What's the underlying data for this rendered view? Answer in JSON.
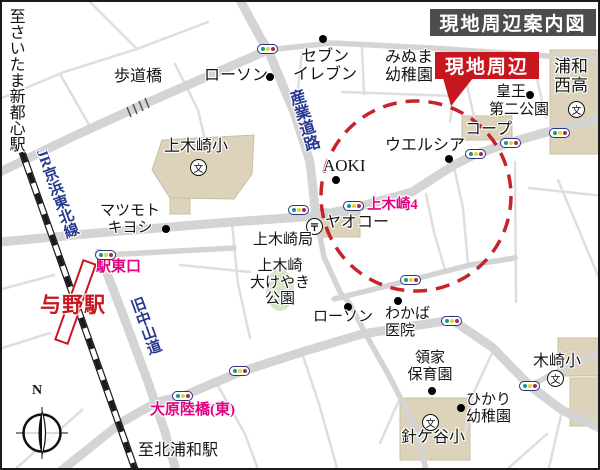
{
  "map": {
    "title": "現地周辺案内図",
    "site_badge": "現地周辺",
    "compass_north": "N"
  },
  "symbols": {
    "school": "文",
    "post_office": "〒"
  },
  "colors": {
    "site_red": "#c7161e",
    "badge_gray": "#4f4c4d",
    "pink": "#e4007f",
    "road_blue": "#273a8f",
    "circle_red": "#c7232b",
    "road_gray": "#d4d4d4",
    "road_light": "#dedede",
    "tan": "#ddd3ba",
    "park_green": "#d4e6c3",
    "signal_teal": "#18988b",
    "signal_yellow": "#efd02a",
    "signal_red": "#973059",
    "signal_border": "#2c3480"
  },
  "labels": {
    "to_saitama_shintoshin": "至さいたま新都心駅",
    "pedestrian_bridge": "歩道橋",
    "lawson_north": "ローソン",
    "seven_eleven_l1": "セブン",
    "seven_eleven_l2": "イレブン",
    "minuma_l1": "みぬま",
    "minuma_l2": "幼稚園",
    "kamikizaki_elementary": "上木崎小",
    "matsumoto_l1": "マツモト",
    "matsumoto_l2": "キヨシ",
    "aoki": "AOKI",
    "welcia": "ウエルシア",
    "coop": "コープ",
    "kozan_l1": "皇王",
    "kozan_l2": "第二公園",
    "urawa_nishi_l1": "浦和",
    "urawa_nishi_l2": "西高",
    "jr_keihin_tohoku": "JR京浜東北線",
    "yono_station": "与野駅",
    "station_east_exit": "駅東口",
    "kyu_nakasendo": "旧中山道",
    "sangyo_road": "産業道路",
    "kamikizaki4": "上木崎4",
    "yaoko": "ヤオコー",
    "kamikizaki_post_office": "上木崎局",
    "okeyaki_l1": "上木崎",
    "okeyaki_l2": "大けやき",
    "okeyaki_l3": "公園",
    "lawson_south": "ローソン",
    "wakaba_l1": "わかば",
    "wakaba_l2": "医院",
    "ryoke_l1": "領家",
    "ryoke_l2": "保育園",
    "hikari_l1": "ひかり",
    "hikari_l2": "幼稚園",
    "harigaya_elementary": "針ケ谷小",
    "kizaki_elementary": "木崎小",
    "ohara_overpass_east": "大原陸橋(東)",
    "to_kita_urawa": "至北浦和駅"
  }
}
